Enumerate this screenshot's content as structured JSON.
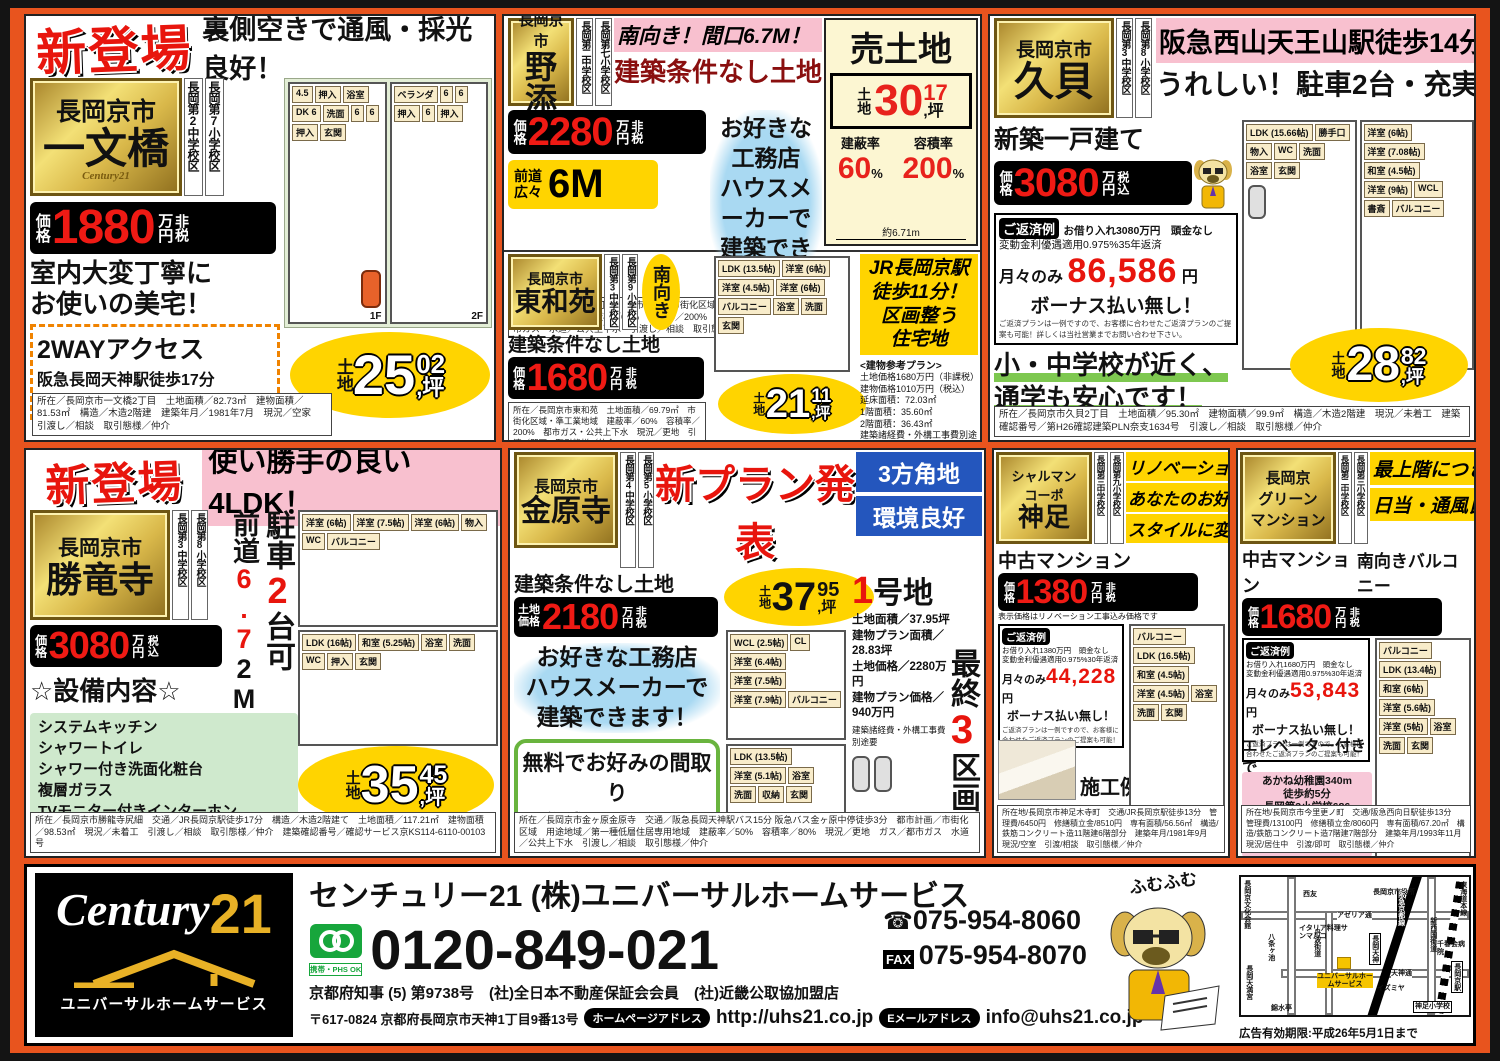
{
  "a": {
    "badge": "新登場",
    "headline": "裏側空きで通風・採光良好！",
    "city": "長岡京市",
    "name": "一文橋",
    "brand": "Century21",
    "schools": [
      "長岡第2中学校区",
      "長岡第7小学校区"
    ],
    "price_label": "価格",
    "price": "1880",
    "unit": "万円",
    "tax": "非税",
    "copy": [
      "室内大変丁寧に",
      "お使いの美宅！"
    ],
    "access_title": "2WAYアクセス",
    "access": [
      "阪急長岡天神駅徒歩17分",
      "JR長岡京駅徒歩18分"
    ],
    "land_prefix": "土地",
    "land_int": "25",
    "land_sup": "02",
    "land_suffix": ",坪",
    "floors": [
      "1F",
      "2F"
    ],
    "rooms1": [
      "4.5",
      "押入",
      "浴室",
      "DK 6",
      "洗面",
      "6",
      "6",
      "押入",
      "玄関"
    ],
    "rooms2": [
      "ベランダ",
      "6",
      "6",
      "押入",
      "6",
      "押入"
    ],
    "fineprint": "所在／長岡京市一文橋2丁目　土地面積／82.73㎡　建物面積／81.53㎡　構造／木造2階建　建築年月／1981年7月　現況／空家　引渡し／相談　取引態様／仲介"
  },
  "b1": {
    "city": "長岡京市",
    "name": "野添",
    "schools": [
      "長岡第二中学校区",
      "長岡第七小学校区"
    ],
    "headline1": "南向き！間口6.7M！",
    "headline2": "建築条件なし土地",
    "price_label": "価格",
    "price": "2280",
    "unit": "万円",
    "tax": "非税",
    "road_label1": "前道",
    "road_label2": "広々",
    "road_value": "6M",
    "pitch": [
      "お好きな工務店",
      "ハウスメーカーで",
      "建築できます！"
    ],
    "fineprint": "所在／長岡京市野添1丁目　都市計画／市街化区域　用途地域／第一種中高層住居専用地域　建蔽率／60%　容積率／200%　現況／古家付　ガス／都市ガス　水道／公共上下水　引渡し／相談　取引態様／仲介"
  },
  "bland": {
    "title": "売土地",
    "land_prefix": "土地",
    "land_int": "30",
    "land_sup": "17",
    "land_suffix": ",坪",
    "kenpei_label": "建蔽率",
    "kenpei": "60",
    "kenpei_unit": "%",
    "yoseki_label": "容積率",
    "yoseki": "200",
    "yoseki_unit": "%",
    "width_note": "約6.71m"
  },
  "b2": {
    "city": "長岡京市",
    "name": "東和苑",
    "schools": [
      "長岡第3中学校区",
      "長岡第9小学校区"
    ],
    "facing": "南向き",
    "subtitle": "建築条件なし土地",
    "price_label": "価格",
    "price": "1680",
    "unit": "万円",
    "tax": "非税",
    "rooms": [
      "LDK (13.5帖)",
      "洋室 (6帖)",
      "洋室 (4.5帖)",
      "洋室 (6帖)",
      "バルコニー",
      "浴室",
      "洗面",
      "玄関"
    ],
    "land_prefix": "土地",
    "land_int": "21",
    "land_sup": "11",
    "land_suffix": ",坪",
    "station": [
      "JR長岡京駅",
      "徒歩11分！",
      "区画整う",
      "住宅地"
    ],
    "plan_title": "<建物参考プラン>",
    "plan_lines": [
      "土地価格1680万円（非課税）",
      "建物価格1010万円（税込）",
      "延床面積：72.03㎡",
      "1階面積：35.60㎡",
      "2階面積：36.43㎡",
      "建築諸経費・外構工事費別途要"
    ],
    "fineprint": "所在／長岡京市東和苑　土地面積／69.79㎡　市街化区域・準工業地域　建蔽率／60%　容積率／200%　都市ガス・公共上下水　現況／更地　引渡／即可　取引態様／仲介"
  },
  "c": {
    "city": "長岡京市",
    "name": "久貝",
    "schools": [
      "長岡第3中学校区",
      "長岡第8小学校区"
    ],
    "headline1": "阪急西山天王山駅徒歩14分！",
    "headline2": "うれしい！駐車2台・充実収納",
    "type": "新築一戸建て",
    "price_label": "価格",
    "price": "3080",
    "unit": "万円",
    "tax": "税込",
    "repay": {
      "label": "ご返済例",
      "line1": "お借り入れ3080万円　頭金なし",
      "line2": "変動金利優遇適用0.975%35年返済",
      "monthly_label": "月々のみ",
      "monthly": "86,586",
      "yen": "円",
      "bonus": "ボーナス払い無し！",
      "note": "ご返済プランは一例ですので、お客様に合わせたご返済プランのご提案も可能！詳しくは当社営業までお問い合わせ下さい。"
    },
    "copy": [
      "小・中学校が近く、",
      "通学も安心です！"
    ],
    "rooms1": [
      "LDK (15.66帖)",
      "勝手口",
      "物入",
      "WC",
      "洗面",
      "浴室",
      "玄関"
    ],
    "rooms2": [
      "洋室 (6帖)",
      "洋室 (7.08帖)",
      "和室 (4.5帖)",
      "洋室 (9帖)",
      "WCL",
      "書斎",
      "バルコニー"
    ],
    "land_prefix": "土地",
    "land_int": "28",
    "land_sup": "82",
    "land_suffix": ",坪",
    "fineprint": "所在／長岡京市久貝2丁目　土地面積／95.30㎡　建物面積／99.9㎡　構造／木造2階建　現況／未着工　建築確認番号／第H26確認建築PLN奈支1634号　引渡し／相談　取引態様／仲介"
  },
  "d": {
    "badge": "新登場",
    "headline": "使い勝手の良い4LDK！",
    "city": "長岡京市",
    "name": "勝竜寺",
    "schools": [
      "長岡第3中学校区",
      "長岡第8小学校区"
    ],
    "road_v": {
      "b1": "前道",
      "red": "6.7",
      "b2": "2M！"
    },
    "park_v": {
      "b1": "駐車",
      "red": "2",
      "b2": "台可"
    },
    "price_label": "価格",
    "price": "3080",
    "unit": "万円",
    "tax": "税込",
    "equip_title": "☆設備内容☆",
    "equipment": [
      "システムキッチン",
      "シャワートイレ",
      "シャワー付き洗面化粧台",
      "複層ガラス",
      "TVモニター付きインターホン"
    ],
    "rooms2": [
      "洋室 (6帖)",
      "洋室 (7.5帖)",
      "洋室 (6帖)",
      "物入",
      "WC",
      "バルコニー"
    ],
    "rooms1": [
      "LDK (16帖)",
      "和室 (5.25帖)",
      "浴室",
      "洗面",
      "WC",
      "押入",
      "玄関"
    ],
    "land_prefix": "土地",
    "land_int": "35",
    "land_sup": "45",
    "land_suffix": ",坪",
    "fineprint": "所在／長岡京市勝龍寺尻細　交通／JR長岡京駅徒歩17分　構造／木造2階建て　土地面積／117.21㎡　建物面積／98.53㎡　現況／未着工　引渡し／相談　取引態様／仲介　建築確認番号／確認サービス京KS114-6110-00103号"
  },
  "e": {
    "city": "長岡京市",
    "name": "金原寺",
    "schools": [
      "長岡第4中学校区",
      "長岡第5小学校区"
    ],
    "headline": "新プラン発表",
    "corner": [
      "3方角地",
      "環境良好"
    ],
    "subtitle": "建築条件なし土地",
    "price_label1": "土地",
    "price_label2": "価格",
    "price": "2180",
    "unit": "万円",
    "tax": "非税",
    "land_prefix": "土地",
    "land_int": "37",
    "land_sup": "95",
    "land_suffix": ",坪",
    "pitch": [
      "お好きな工務店",
      "ハウスメーカーで",
      "建築できます！"
    ],
    "free_plan": [
      "無料でお好みの間取り",
      "作成承ります！"
    ],
    "lot_no": "1",
    "lot_title": "号地",
    "lot_lines": [
      "土地面積／37.95坪",
      "建物プラン面積／28.83坪",
      "土地価格／2280万円",
      "建物プラン価格／940万円"
    ],
    "lot_note": "建築諸経費・外構工事費別途要",
    "last1": "最終",
    "last_n": "3",
    "last2": "区画",
    "rooms2": [
      "WCL (2.5帖)",
      "CL",
      "洋室 (6.4帖)",
      "洋室 (7.5帖)",
      "洋室 (7.9帖)",
      "バルコニー"
    ],
    "rooms1": [
      "LDK (13.5帖)",
      "洋室 (5.1帖)",
      "浴室",
      "洗面",
      "収納",
      "玄関"
    ],
    "fineprint": "所在／長岡京市金ヶ原金原寺　交通／阪急長岡天神駅バス15分 阪急バス金ヶ原中停徒歩3分　都市計画／市街化区域　用途地域／第一種低層住居専用地域　建蔽率／50%　容積率／80%　現況／更地　ガス／都市ガス　水道／公共上下水　引渡し／相談　取引態様／仲介"
  },
  "f": {
    "name_lines": [
      "シャルマン",
      "コーポ",
      "神足"
    ],
    "schools": [
      "長岡第三中学校区",
      "長岡第九小学校区"
    ],
    "headline": [
      "リノベーションで",
      "あなたのお好み",
      "スタイルに変身！"
    ],
    "type": "中古マンション",
    "price_label": "価格",
    "price": "1380",
    "unit": "万円",
    "tax": "非税",
    "note": "表示価格はリノベーション工事込み価格です",
    "repay": {
      "label": "ご返済例",
      "line1": "お借り入れ1380万円　頭金なし",
      "line2": "変動金利優遇適用0.975%30年返済",
      "monthly_label": "月々のみ",
      "monthly": "44,228",
      "yen": "円",
      "bonus": "ボーナス払い無し！",
      "note": "ご返済プランは一例ですので、お客様に合わせたご返済プランのご提案も可能！"
    },
    "example_label": "施工例",
    "rooms": [
      "バルコニー",
      "LDK (16.5帖)",
      "和室 (4.5帖)",
      "洋室 (4.5帖)",
      "浴室",
      "洗面",
      "玄関"
    ],
    "fineprint": "所在地/長岡京市神足木寺町　交通/JR長岡京駅徒歩13分　管理費/6450円　修繕積立金/8510円　専有面積/56.56㎡　構造/鉄筋コンクリート造11階建6階部分　建築年月/1981年9月　現況/空室　引渡/相談　取引態様／仲介"
  },
  "g": {
    "name_lines": [
      "長岡京",
      "グリーン",
      "マンション"
    ],
    "schools": [
      "長岡第二中学校区",
      "長岡第三小学校区"
    ],
    "headline": [
      "最上階につき",
      "日当・通風良好"
    ],
    "type": "中古マンション",
    "price_label": "価格",
    "price": "1680",
    "unit": "万円",
    "tax": "非税",
    "balcony": "南向きバルコニー",
    "repay": {
      "label": "ご返済例",
      "line1": "お借り入れ1680万円　頭金なし",
      "line2": "変動金利優遇適用0.975%30年返済",
      "monthly_label": "月々のみ",
      "monthly": "53,843",
      "yen": "円",
      "bonus": "ボーナス払い無し！",
      "note": "ご返済プランは一例ですので、お客様に合わせたご返済プランのご提案も可能！"
    },
    "elevator": [
      "エレベーター付きで",
      "大きな買物も楽々！"
    ],
    "walk_note": [
      "あかね幼稚園340m",
      "徒歩約5分",
      "長岡第3小学校686",
      "m徒歩約9分",
      "長岡第2中学校594",
      "m徒歩約7分"
    ],
    "rooms": [
      "バルコニー",
      "LDK (13.4帖)",
      "和室 (6帖)",
      "洋室 (5.6帖)",
      "洋室 (5帖)",
      "浴室",
      "洗面",
      "玄関"
    ],
    "fineprint": "所在地/長岡京市今里更ノ町　交通/阪急西向日駅徒歩13分　管理費/13100円　修繕積立金/8060円　専有面積/67.20㎡　構造/鉄筋コンクリート造7階建7階部分　建築年月/1993年11月　現況/居住中　引渡/即可　取引態様／仲介"
  },
  "footer": {
    "logo_brand": "Century",
    "logo_21": "21",
    "logo_sub": "ユニバーサルホームサービス",
    "company": "センチュリー21 (株)ユニバーサルホームサービス",
    "freedial_ok": "携帯・PHS OK",
    "freephone": "0120-849-021",
    "tel_icon": "☎",
    "tel": "075-954-8060",
    "fax_label": "FAX",
    "fax": "075-954-8070",
    "license": "京都府知事 (5) 第9738号　(社)全日本不動産保証会会員　(社)近畿公取協加盟店",
    "address": "〒617-0824 京都府長岡京市天神1丁目9番13号",
    "hp_label": "ホームページアドレス",
    "hp": "http://uhs21.co.jp",
    "mail_label": "Eメールアドレス",
    "mail": "info@uhs21.co.jp",
    "mascot_text": "ふむふむ",
    "expiry": "広告有効期限:平成26年5月1日まで",
    "map": [
      "長岡京文化会館",
      "西友",
      "アゼリア通",
      "長岡京市役所",
      "イタリア料理サンマルコ",
      "八条ヶ池",
      "丹波街道",
      "阪急京都線",
      "長岡天神",
      "新西国街道",
      "千春会病院",
      "天神通",
      "イズミヤ",
      "神足小学校",
      "東海道本線",
      "長岡京駅",
      "錦水亭",
      "長岡天満宮",
      "ユニバーサルホームサービス"
    ]
  }
}
